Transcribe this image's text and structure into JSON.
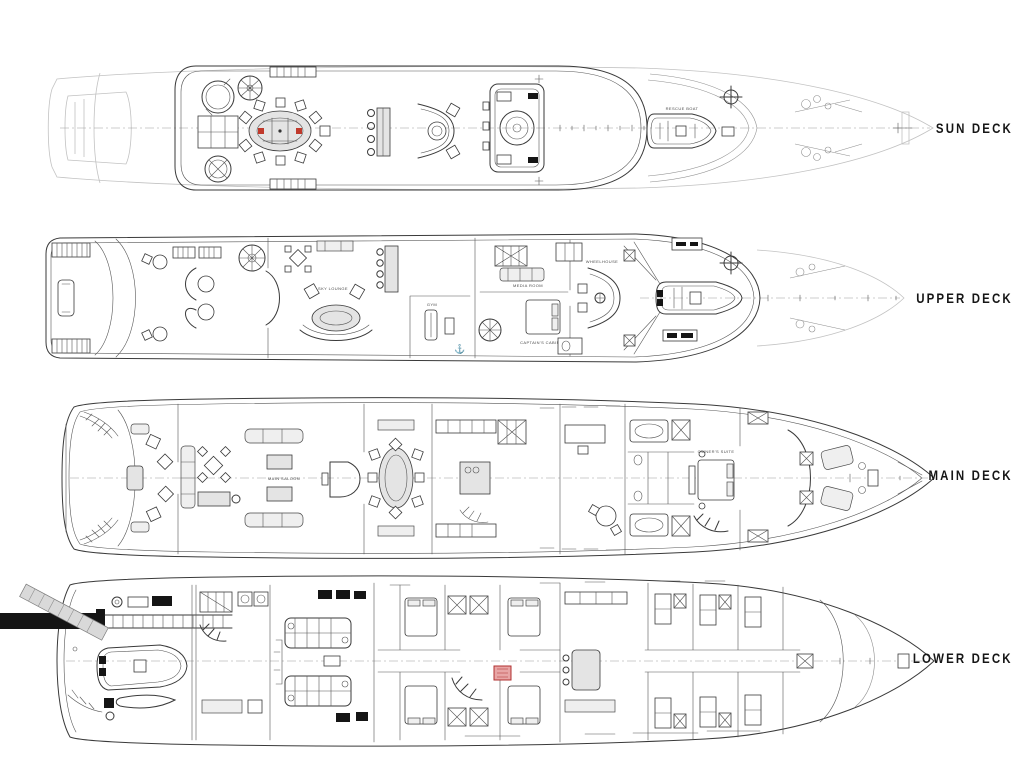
{
  "page": {
    "background": "#ffffff",
    "description": "Yacht general arrangement - four deck plans"
  },
  "decks": [
    {
      "id": "sun-deck",
      "label": "SUN DECK"
    },
    {
      "id": "upper-deck",
      "label": "UPPER DECK"
    },
    {
      "id": "main-deck",
      "label": "MAIN DECK"
    },
    {
      "id": "lower-deck",
      "label": "LOWER DECK"
    }
  ],
  "plan_annotations": {
    "rescue_boat": "RESCUE BOAT",
    "sky_lounge": "SKY LOUNGE",
    "gym": "GYM",
    "media_room": "MEDIA ROOM",
    "captains_cabin": "CAPTAIN'S CABIN",
    "wheelhouse": "WHEELHOUSE",
    "main_saloon": "MAIN SALOON",
    "owners_suite": "OWNER'S SUITE"
  },
  "colors": {
    "line": "#3a3a3a",
    "faint": "#c2c2c2",
    "accent_red": "#c0392b",
    "lift_fill": "#e8a5a5",
    "lift_stroke": "#b03030"
  }
}
